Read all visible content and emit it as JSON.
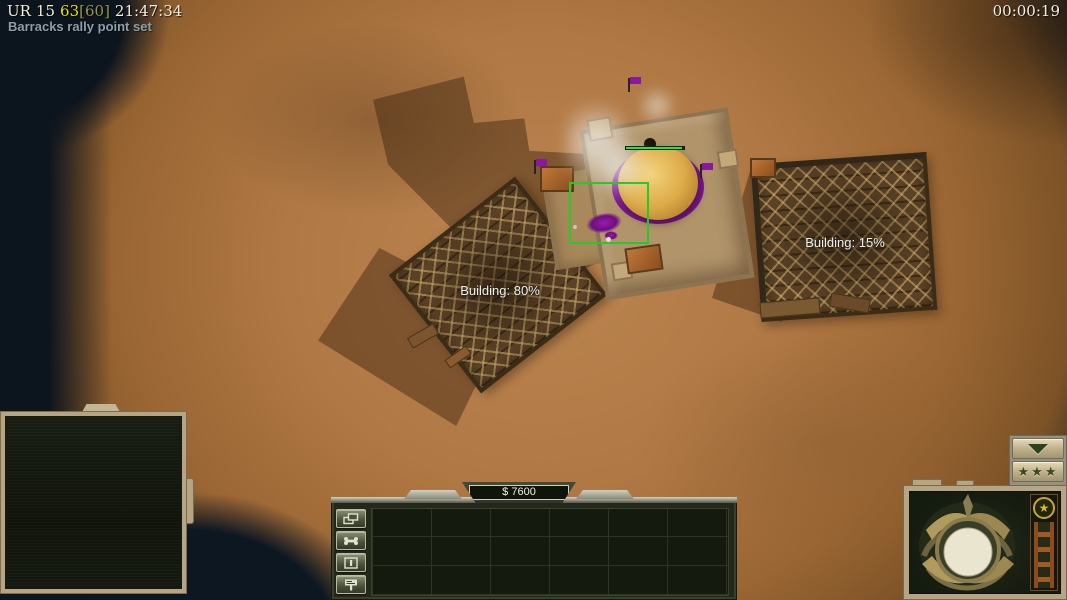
{
  "hud": {
    "debug": {
      "label": "UR",
      "value": "15",
      "fps": "63",
      "fps_cap": "[60]",
      "clock": "21:47:34"
    },
    "event_message": "Barracks rally point set",
    "match_timer": "00:00:19",
    "resolution_overlay": "1366 x 768"
  },
  "world": {
    "selection": {
      "type": "building",
      "health_pct": 96
    },
    "construction_labels": [
      {
        "side": "left",
        "label": "Building: 80%"
      },
      {
        "side": "right",
        "label": "Building: 15%"
      }
    ]
  },
  "control_bar": {
    "money_display": "$ 7600",
    "side_buttons": [
      {
        "name": "windows-icon"
      },
      {
        "name": "bone-icon"
      },
      {
        "name": "pause-icon"
      },
      {
        "name": "signpost-icon"
      }
    ]
  },
  "right_panel": {
    "rank_badge_star": "★",
    "rank_button_stars": "★★★"
  },
  "colors": {
    "selection_green": "#28c828",
    "health_green": "#2be42b",
    "fps_yellow": "#e6df1e",
    "desert": "#ad7540",
    "panel_beige": "#b5a584",
    "panel_dark_green": "#151a0e",
    "flag_purple": "#8d17a0"
  }
}
